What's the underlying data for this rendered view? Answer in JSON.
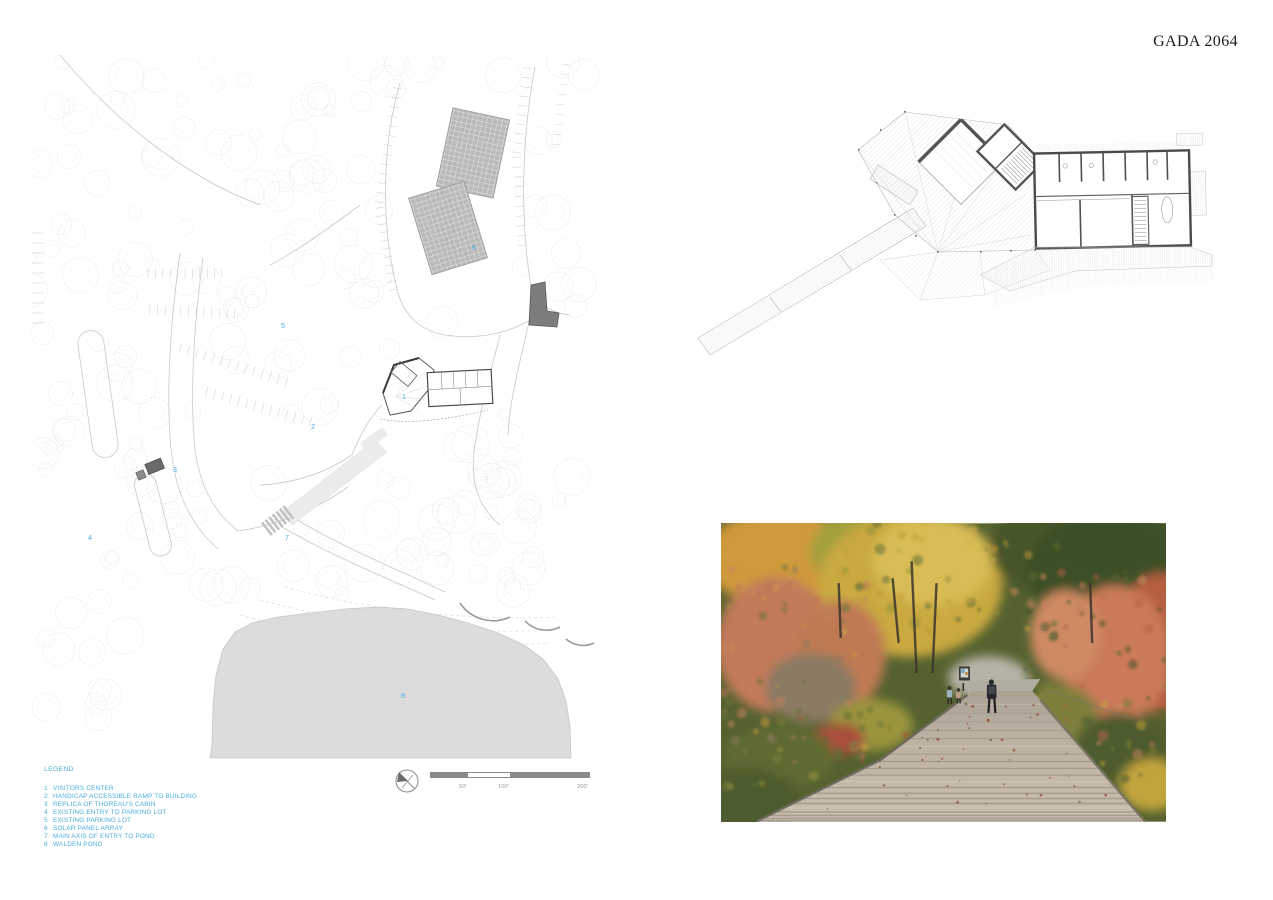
{
  "header": {
    "title": "GADA 2064"
  },
  "legend": {
    "title": "LEGEND",
    "items": [
      {
        "num": "1",
        "label": "VISITORS CENTER"
      },
      {
        "num": "2",
        "label": "HANDICAP ACCESSIBLE RAMP TO BUILDING"
      },
      {
        "num": "3",
        "label": "REPLICA OF THOREAU'S CABIN"
      },
      {
        "num": "4",
        "label": "EXISTING ENTRY TO PARKING LOT"
      },
      {
        "num": "5",
        "label": "EXISTING PARKING LOT"
      },
      {
        "num": "6",
        "label": "SOLAR PANEL ARRAY"
      },
      {
        "num": "7",
        "label": "MAIN AXIS OF ENTRY TO POND"
      },
      {
        "num": "8",
        "label": "WALDEN POND"
      }
    ]
  },
  "scale_bar": {
    "labels": [
      "50'",
      "100'",
      "200'"
    ]
  },
  "colors": {
    "accent_blue": "#4aace0",
    "pond_gray": "#dcdcde",
    "solar_panel_gray": "#b9b9b9",
    "building_dark_gray": "#7d7d7d",
    "plan_wall_gray": "#4f4f4f"
  }
}
